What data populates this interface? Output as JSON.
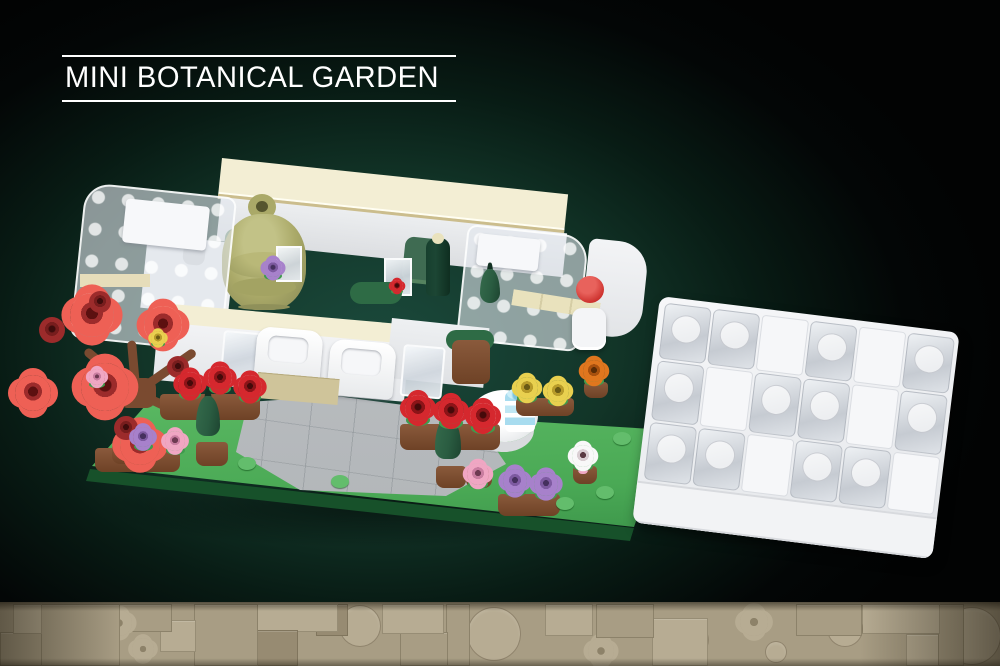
{
  "title": {
    "label": "MINI BOTANICAL GARDEN"
  },
  "scene": {
    "description": "Rendered LEGO-style mini botanical garden model with a separate clear-brick lid build, on a dark teal-glow background with a tan tile strip along the bottom"
  },
  "palette": {
    "background": "#030404",
    "glow": "#1b4a3c",
    "title_text": "#ffffff",
    "baseplate_green": "#4fb05a",
    "baseplate_edge": "#1e6930",
    "cream": "#f3eed4",
    "tan_trim": "#cbbd8d",
    "white_brick": "#f2f3f5",
    "trans_clear": "#dde3e9",
    "path_gray": "#b6babd",
    "olive": "#aaa968",
    "sage": "#6e9070",
    "pine_green": "#2a5c41",
    "bottle_green": "#1c4634",
    "coral": "#ee6055",
    "rose": "#d5282e",
    "barrel_red": "#9c2b2b",
    "yellow": "#e9d04f",
    "orange": "#e0761e",
    "purple": "#a781cb",
    "pink": "#f0a6c3",
    "white_flower": "#f8f8f8",
    "cup_blue": "#a8dcef",
    "pot_brown": "#8a5a3c",
    "collar_green": "#3f9b4d",
    "stud_green": "#63bd6c",
    "footer_tan": "#a89d84",
    "footer_light": "#b7ac93",
    "footer_dark": "#978b72"
  },
  "garden_build": {
    "label": "mini botanical garden model",
    "branches": [
      {
        "x": 136,
        "y": 388,
        "len": 66,
        "ang": -140
      },
      {
        "x": 136,
        "y": 388,
        "len": 72,
        "ang": -35
      },
      {
        "x": 136,
        "y": 388,
        "len": 58,
        "ang": 25
      },
      {
        "x": 136,
        "y": 388,
        "len": 52,
        "ang": -95
      }
    ],
    "pots": [
      {
        "x": 160,
        "y": 394,
        "w": 100,
        "h": 26
      },
      {
        "x": 400,
        "y": 424,
        "w": 100,
        "h": 26
      },
      {
        "x": 95,
        "y": 448,
        "w": 85,
        "h": 24
      },
      {
        "x": 498,
        "y": 494,
        "w": 62,
        "h": 22
      },
      {
        "x": 466,
        "y": 468,
        "w": 26,
        "h": 20
      },
      {
        "x": 573,
        "y": 466,
        "w": 24,
        "h": 18
      },
      {
        "x": 516,
        "y": 398,
        "w": 58,
        "h": 18
      },
      {
        "x": 584,
        "y": 382,
        "w": 24,
        "h": 16
      },
      {
        "x": 196,
        "y": 442,
        "w": 32,
        "h": 24
      },
      {
        "x": 436,
        "y": 466,
        "w": 30,
        "h": 22
      },
      {
        "x": 112,
        "y": 444,
        "w": 30,
        "h": 20
      }
    ],
    "cones": [
      {
        "x": 208,
        "y": 416,
        "w": 24,
        "h": 40
      },
      {
        "x": 448,
        "y": 438,
        "w": 26,
        "h": 42
      },
      {
        "x": 490,
        "y": 286,
        "w": 20,
        "h": 34
      }
    ],
    "studs": [
      {
        "x": 247,
        "y": 463
      },
      {
        "x": 340,
        "y": 481
      },
      {
        "x": 565,
        "y": 503
      },
      {
        "x": 648,
        "y": 466
      },
      {
        "x": 622,
        "y": 438
      },
      {
        "x": 605,
        "y": 492
      }
    ],
    "flowers": [
      {
        "x": 92,
        "y": 315,
        "r": 22,
        "t": "coral"
      },
      {
        "x": 163,
        "y": 325,
        "r": 19,
        "t": "coral"
      },
      {
        "x": 105,
        "y": 387,
        "r": 24,
        "t": "coral"
      },
      {
        "x": 33,
        "y": 393,
        "r": 18,
        "t": "coral"
      },
      {
        "x": 140,
        "y": 445,
        "r": 20,
        "t": "coral"
      },
      {
        "x": 52,
        "y": 330,
        "r": 13,
        "t": "barrel"
      },
      {
        "x": 100,
        "y": 302,
        "r": 11,
        "t": "barrel"
      },
      {
        "x": 178,
        "y": 367,
        "r": 11,
        "t": "barrel"
      },
      {
        "x": 126,
        "y": 428,
        "r": 12,
        "t": "barrel"
      },
      {
        "x": 97,
        "y": 377,
        "r": 8,
        "t": "pink"
      },
      {
        "x": 158,
        "y": 338,
        "r": 7,
        "t": "yellow"
      },
      {
        "x": 190,
        "y": 384,
        "r": 12,
        "t": "rose"
      },
      {
        "x": 220,
        "y": 378,
        "r": 12,
        "t": "rose"
      },
      {
        "x": 250,
        "y": 387,
        "r": 12,
        "t": "rose"
      },
      {
        "x": 418,
        "y": 408,
        "r": 13,
        "t": "rose"
      },
      {
        "x": 451,
        "y": 411,
        "r": 13,
        "t": "rose"
      },
      {
        "x": 483,
        "y": 416,
        "r": 13,
        "t": "rose"
      },
      {
        "x": 527,
        "y": 388,
        "r": 11,
        "t": "yellow"
      },
      {
        "x": 558,
        "y": 391,
        "r": 11,
        "t": "yellow"
      },
      {
        "x": 594,
        "y": 371,
        "r": 11,
        "t": "orange"
      },
      {
        "x": 143,
        "y": 437,
        "r": 10,
        "t": "purple"
      },
      {
        "x": 175,
        "y": 441,
        "r": 10,
        "t": "pink"
      },
      {
        "x": 515,
        "y": 481,
        "r": 12,
        "t": "purple"
      },
      {
        "x": 546,
        "y": 484,
        "r": 12,
        "t": "purple"
      },
      {
        "x": 478,
        "y": 474,
        "r": 11,
        "t": "pink"
      },
      {
        "x": 583,
        "y": 456,
        "r": 11,
        "t": "white"
      },
      {
        "x": 273,
        "y": 268,
        "r": 9,
        "t": "purple"
      },
      {
        "x": 397,
        "y": 286,
        "r": 6,
        "t": "rose"
      }
    ]
  },
  "lid_build": {
    "label": "clear-brick lid build",
    "rows": [
      "T,T,W,T,W,T",
      "T,W,T,T,W,T",
      "T,T,W,T,T,W"
    ]
  },
  "footer": {
    "label": "tan LEGO tile mosaic strip",
    "tiles": [
      {
        "s": "rect",
        "x": 13,
        "y": 2,
        "w": 27,
        "h": 28,
        "tone": "light"
      },
      {
        "s": "rect",
        "x": 0,
        "y": 30,
        "w": 40,
        "h": 32,
        "tone": "mid"
      },
      {
        "s": "rect",
        "x": 40,
        "y": 2,
        "w": 78,
        "h": 60,
        "tone": "mid"
      },
      {
        "s": "circle",
        "x": 58,
        "y": 16,
        "w": 32,
        "h": 32,
        "tone": "light"
      },
      {
        "s": "flower",
        "x": 106,
        "y": 8,
        "w": 26,
        "h": 26,
        "tone": "light"
      },
      {
        "s": "flower",
        "x": 132,
        "y": 36,
        "w": 22,
        "h": 22,
        "tone": "light"
      },
      {
        "s": "rect",
        "x": 118,
        "y": 2,
        "w": 52,
        "h": 26,
        "tone": "mid"
      },
      {
        "s": "rect",
        "x": 160,
        "y": 18,
        "w": 34,
        "h": 30,
        "tone": "light"
      },
      {
        "s": "rect",
        "x": 194,
        "y": 2,
        "w": 62,
        "h": 60,
        "tone": "mid"
      },
      {
        "s": "stud",
        "x": 200,
        "y": 12,
        "w": 16,
        "h": 16,
        "tone": "light"
      },
      {
        "s": "stud",
        "x": 228,
        "y": 10,
        "w": 16,
        "h": 16,
        "tone": "light"
      },
      {
        "s": "stud",
        "x": 206,
        "y": 40,
        "w": 15,
        "h": 15,
        "tone": "light"
      },
      {
        "s": "wedge",
        "x": 224,
        "y": 34,
        "w": 28,
        "h": 26,
        "tone": "light"
      },
      {
        "s": "rect",
        "x": 256,
        "y": 28,
        "w": 40,
        "h": 34,
        "tone": "dark"
      },
      {
        "s": "stud",
        "x": 264,
        "y": 38,
        "w": 16,
        "h": 16,
        "tone": "light"
      },
      {
        "s": "rect",
        "x": 256,
        "y": 2,
        "w": 80,
        "h": 26,
        "tone": "light"
      },
      {
        "s": "rect",
        "x": 316,
        "y": 2,
        "w": 30,
        "h": 30,
        "tone": "dark"
      },
      {
        "s": "stud",
        "x": 322,
        "y": 8,
        "w": 15,
        "h": 15,
        "tone": "light"
      },
      {
        "s": "circle",
        "x": 340,
        "y": 4,
        "w": 40,
        "h": 40,
        "tone": "light"
      },
      {
        "s": "rect",
        "x": 382,
        "y": 2,
        "w": 60,
        "h": 28,
        "tone": "light"
      },
      {
        "s": "rect",
        "x": 400,
        "y": 30,
        "w": 46,
        "h": 32,
        "tone": "mid"
      },
      {
        "s": "rect",
        "x": 446,
        "y": 2,
        "w": 22,
        "h": 60,
        "tone": "mid"
      },
      {
        "s": "circle",
        "x": 468,
        "y": 6,
        "w": 52,
        "h": 52,
        "tone": "light"
      },
      {
        "s": "stud",
        "x": 486,
        "y": 24,
        "w": 16,
        "h": 16,
        "tone": "dark"
      },
      {
        "s": "rect",
        "x": 545,
        "y": 2,
        "w": 46,
        "h": 30,
        "tone": "light"
      },
      {
        "s": "stud",
        "x": 558,
        "y": 8,
        "w": 18,
        "h": 18,
        "tone": "light"
      },
      {
        "s": "rect",
        "x": 596,
        "y": 2,
        "w": 56,
        "h": 32,
        "tone": "mid"
      },
      {
        "s": "circle",
        "x": 614,
        "y": 8,
        "w": 20,
        "h": 20,
        "tone": "light"
      },
      {
        "s": "flower",
        "x": 588,
        "y": 36,
        "w": 26,
        "h": 26,
        "tone": "light"
      },
      {
        "s": "rect",
        "x": 652,
        "y": 16,
        "w": 54,
        "h": 46,
        "tone": "light"
      },
      {
        "s": "circle",
        "x": 680,
        "y": 24,
        "w": 28,
        "h": 28,
        "tone": "mid"
      },
      {
        "s": "flower",
        "x": 740,
        "y": 6,
        "w": 28,
        "h": 28,
        "tone": "light"
      },
      {
        "s": "circle",
        "x": 766,
        "y": 40,
        "w": 20,
        "h": 20,
        "tone": "light"
      },
      {
        "s": "rect",
        "x": 796,
        "y": 2,
        "w": 64,
        "h": 30,
        "tone": "mid"
      },
      {
        "s": "circle",
        "x": 828,
        "y": 10,
        "w": 34,
        "h": 34,
        "tone": "light"
      },
      {
        "s": "rect",
        "x": 862,
        "y": 2,
        "w": 76,
        "h": 28,
        "tone": "light"
      },
      {
        "s": "rect",
        "x": 938,
        "y": 2,
        "w": 24,
        "h": 60,
        "tone": "mid"
      },
      {
        "s": "rect",
        "x": 906,
        "y": 32,
        "w": 32,
        "h": 30,
        "tone": "light"
      },
      {
        "s": "circle",
        "x": 944,
        "y": 6,
        "w": 56,
        "h": 56,
        "tone": "light"
      },
      {
        "s": "stud",
        "x": 968,
        "y": 26,
        "w": 18,
        "h": 18,
        "tone": "dark"
      }
    ]
  }
}
